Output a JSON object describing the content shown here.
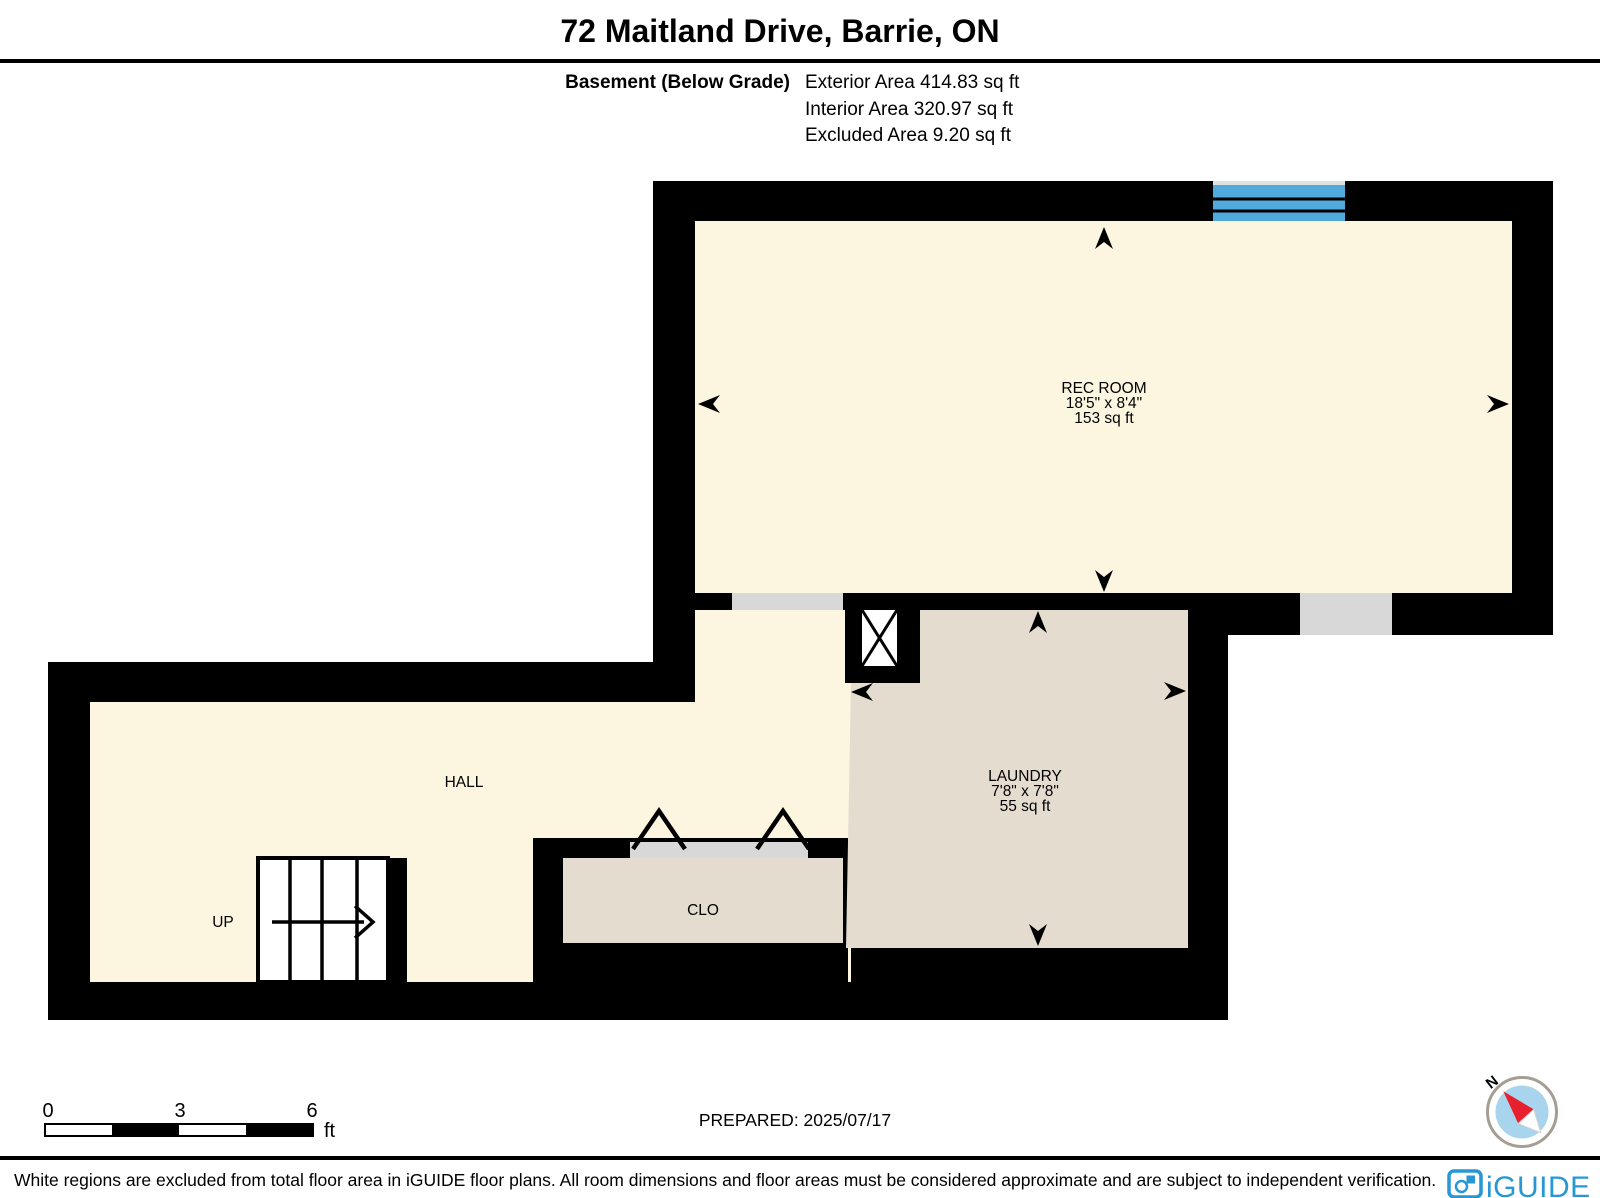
{
  "header": {
    "title": "72 Maitland Drive, Barrie, ON",
    "floor_label": "Basement (Below Grade)",
    "exterior_area": "Exterior Area 414.83 sq ft",
    "interior_area": "Interior Area 320.97 sq ft",
    "excluded_area": "Excluded Area 9.20 sq ft"
  },
  "rooms": {
    "rec_room": {
      "name": "REC ROOM",
      "dimensions": "18'5\" x 8'4\"",
      "area": "153 sq ft"
    },
    "laundry": {
      "name": "LAUNDRY",
      "dimensions": "7'8\" x 7'8\"",
      "area": "55 sq ft"
    },
    "hall": {
      "name": "HALL"
    },
    "closet": {
      "name": "CLO"
    },
    "stairs": {
      "label": "UP"
    }
  },
  "scale_bar": {
    "tick_0": "0",
    "tick_3": "3",
    "tick_6": "6",
    "unit": "ft"
  },
  "prepared_label": "PREPARED: 2025/07/17",
  "compass": {
    "north_label": "N"
  },
  "footer": {
    "disclaimer": "White regions are excluded from total floor area in iGUIDE floor plans. All room dimensions and floor areas must be considered approximate and are subject to independent verification.",
    "brand": "iGUIDE"
  },
  "colors": {
    "wall_black": "#000000",
    "floor_cream": "#fcf5e0",
    "room_tan": "#e5dcd0",
    "door_gray": "#d8d8d8",
    "window_blue": "#51aadc",
    "brand_blue": "#2798d4",
    "compass_red": "#e8202d",
    "compass_blue": "#a9d4ee"
  }
}
